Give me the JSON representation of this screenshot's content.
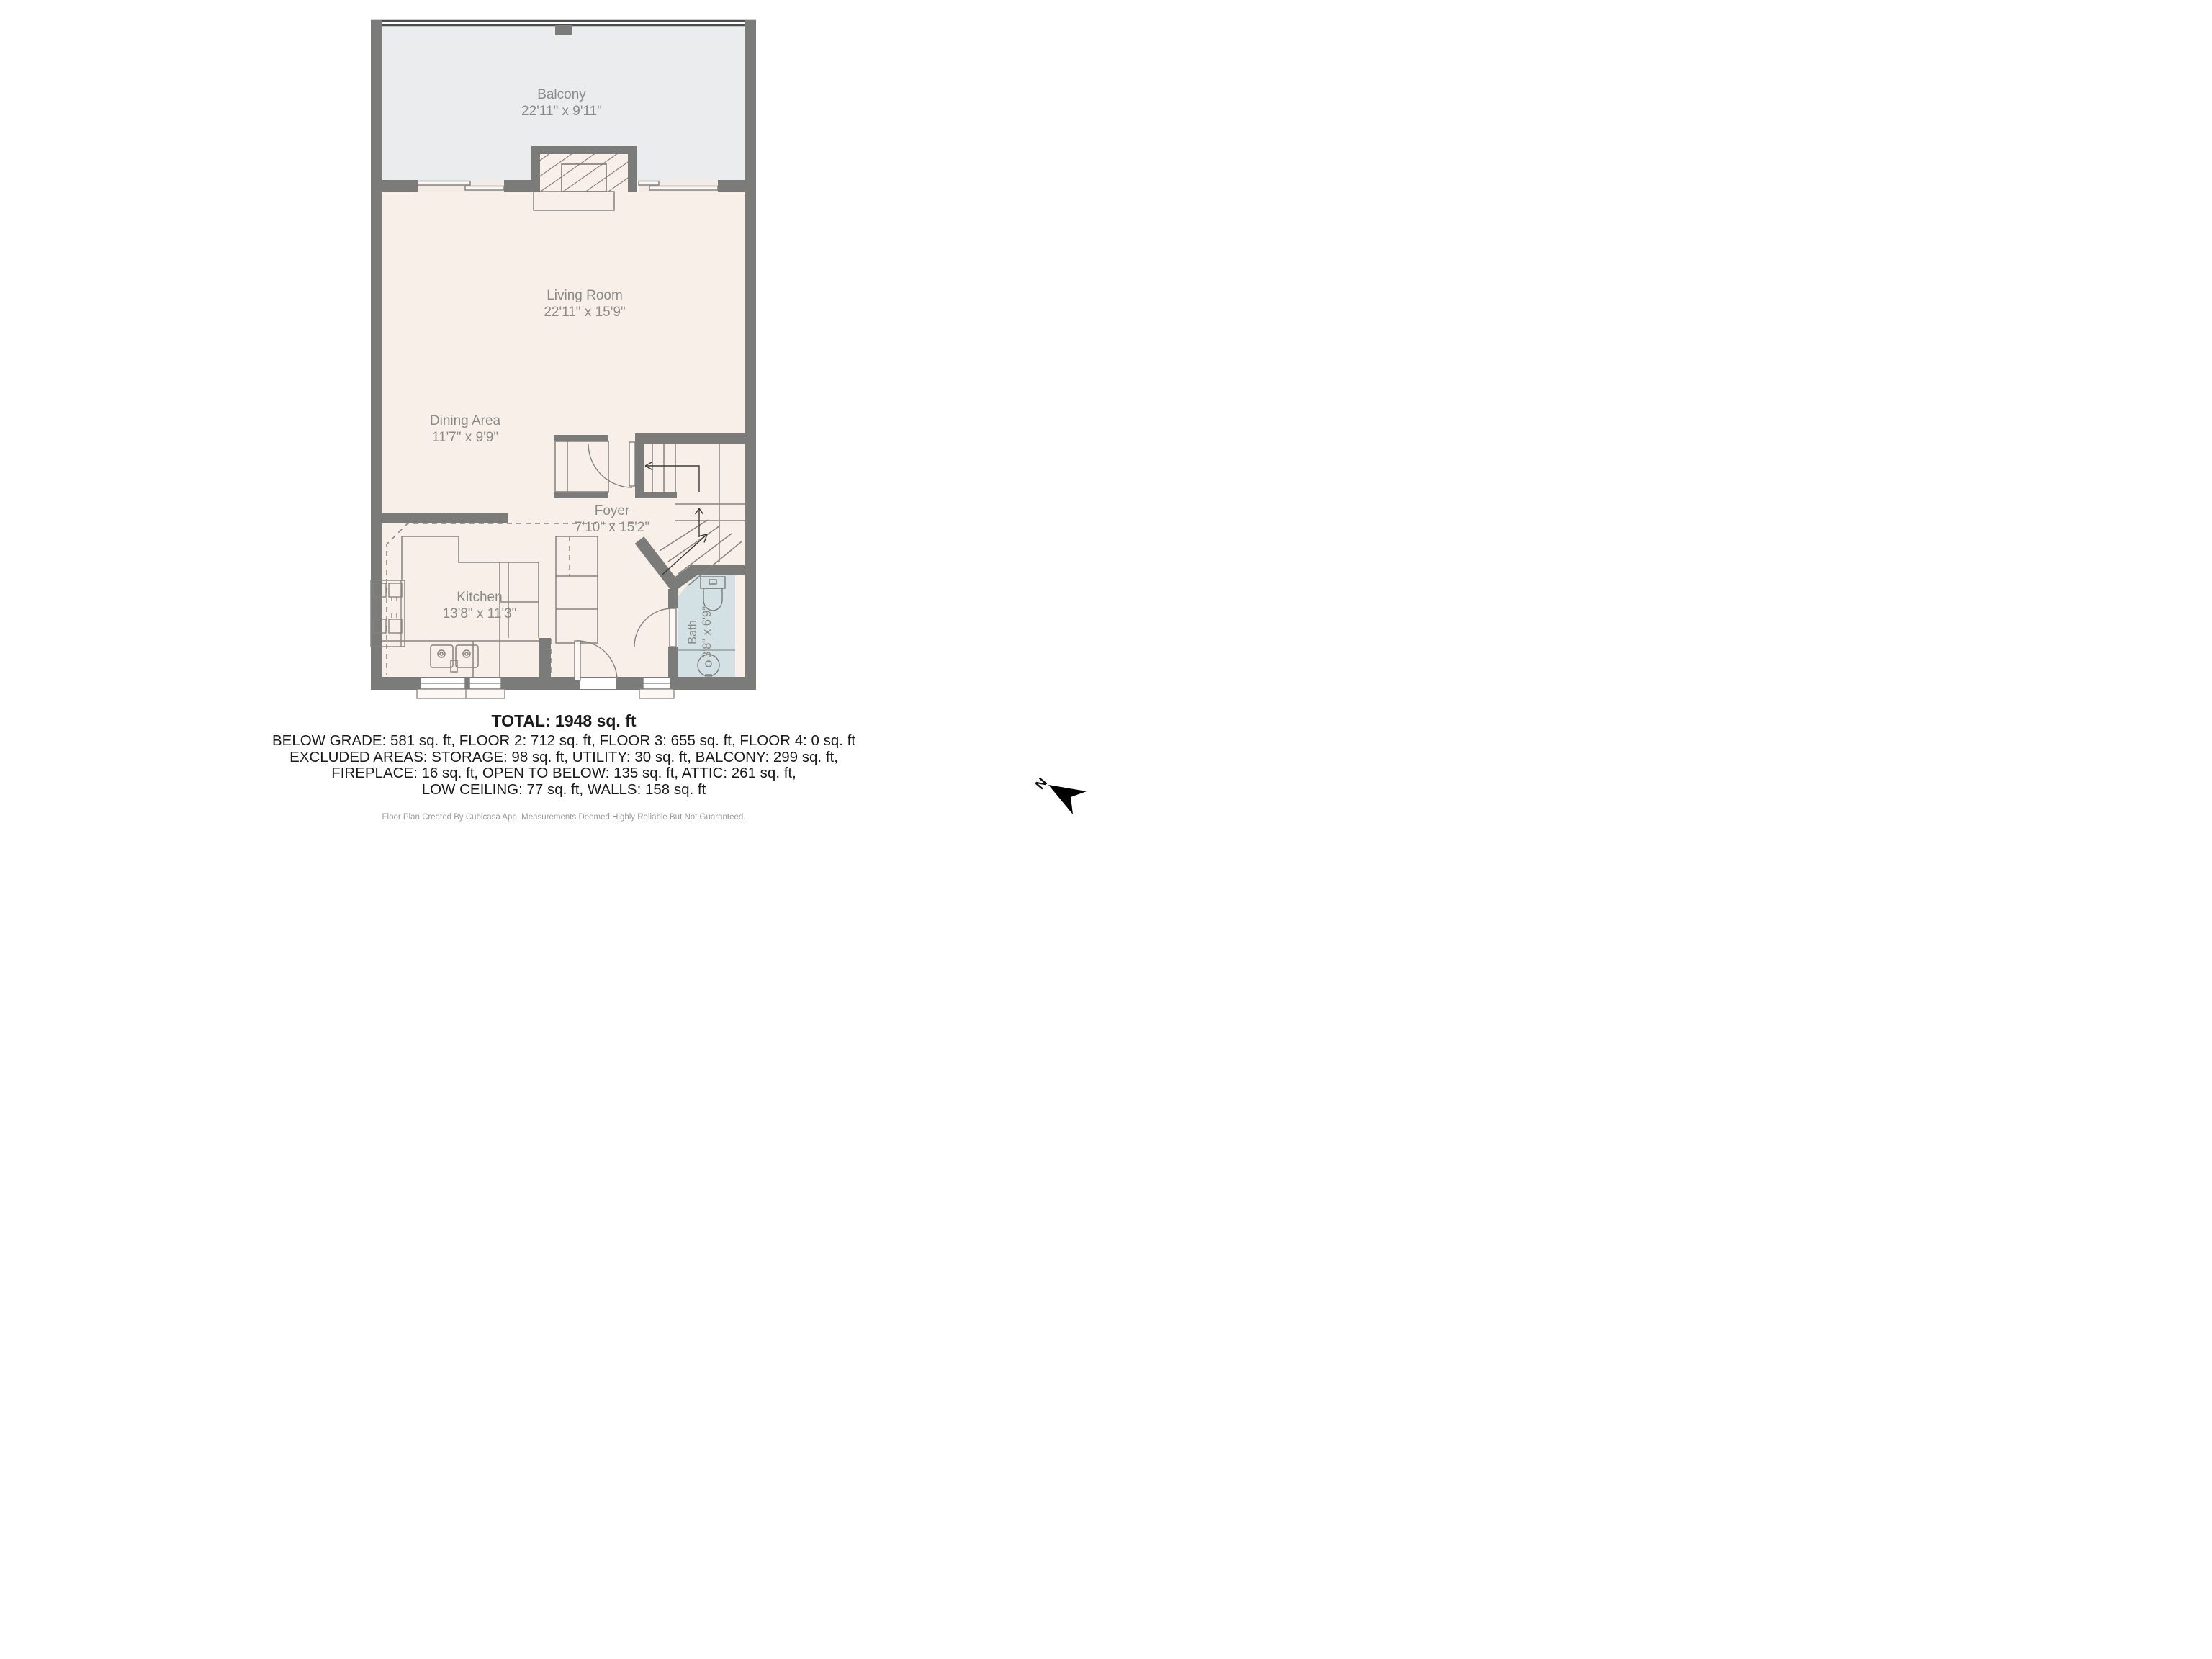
{
  "colors": {
    "wall": "#7b7b79",
    "balcony_fill": "#ebeced",
    "floor_fill": "#f8f0e8",
    "bath_fill": "#d3e1e4",
    "thin_line": "#85837f",
    "label_text": "#8a8a88",
    "summary_text": "#1a1a1a",
    "footer_text": "#9b9b9b",
    "north_arrow": "#000000"
  },
  "rooms": {
    "balcony": {
      "name": "Balcony",
      "dims": "22'11\" x 9'11\""
    },
    "living_room": {
      "name": "Living Room",
      "dims": "22'11\" x 15'9\""
    },
    "dining_area": {
      "name": "Dining Area",
      "dims": "11'7\" x 9'9\""
    },
    "foyer": {
      "name": "Foyer",
      "dims": "7'10\" x 15'2\""
    },
    "kitchen": {
      "name": "Kitchen",
      "dims": "13'8\" x 11'3\""
    },
    "bath": {
      "name": "Bath",
      "dims": "3'8\" x 6'9\""
    }
  },
  "summary": {
    "total": "TOTAL: 1948 sq. ft",
    "lines": [
      "BELOW GRADE: 581 sq. ft, FLOOR 2: 712 sq. ft, FLOOR 3: 655 sq. ft, FLOOR 4: 0 sq. ft",
      "EXCLUDED AREAS: STORAGE: 98 sq. ft, UTILITY: 30 sq. ft, BALCONY: 299 sq. ft,",
      "FIREPLACE: 16 sq. ft, OPEN TO BELOW: 135 sq. ft, ATTIC: 261 sq. ft,",
      "LOW CEILING: 77 sq. ft, WALLS: 158 sq. ft"
    ],
    "footer": "Floor Plan Created By Cubicasa App. Measurements Deemed Highly Reliable But Not Guaranteed."
  },
  "compass": {
    "north_label": "N"
  }
}
